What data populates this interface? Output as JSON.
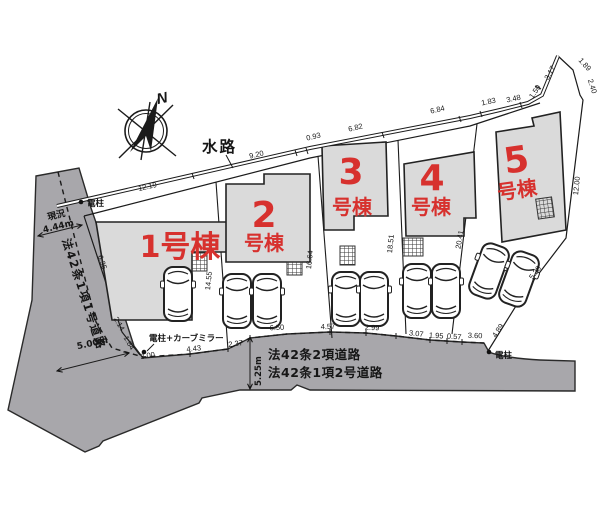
{
  "colors": {
    "road_fill": "#a8a7ab",
    "building_fill": "#dadada",
    "lot_label": "#d7312e",
    "line": "#1b1b1b"
  },
  "compass": {
    "north": "N"
  },
  "waterway": {
    "name": "水路",
    "segments": [
      "12.19",
      "9.20",
      "0.93",
      "6.82",
      "6.84",
      "1.83",
      "3.48",
      "1.59",
      "3.17"
    ]
  },
  "east_boundary": {
    "segments": [
      "1.89",
      "2.40",
      "12.00",
      "5.28",
      "4.89"
    ]
  },
  "lot_boundary_dims": {
    "d1_2": "14.55",
    "d2_3": "16.64",
    "d3_4": "18.51",
    "d4_5": "20.41"
  },
  "west_road": {
    "name": "法42条1項1号道路",
    "existing_label": "現況",
    "existing_width": "4.44m",
    "width": "5.00m",
    "corner_segments": [
      "2.14",
      "1.84"
    ],
    "front_dim": "3.00",
    "lot1_edge_dim": "6.35"
  },
  "south_road": {
    "name_line1": "法42条2項道路",
    "name_line2": "法42条1項2号道路",
    "width": "5.25m",
    "frontage_dims": [
      "4.43",
      "2.37",
      "6.50",
      "4.57",
      "2.99",
      "3.07",
      "1.95",
      "0.57",
      "3.60"
    ]
  },
  "poles": {
    "northwest": "電柱",
    "corner": "電柱+カーブミラー",
    "southeast": "電柱"
  },
  "lots": [
    {
      "label": "1号棟",
      "num": "1",
      "suffix": "号棟"
    },
    {
      "label": "2号棟",
      "num": "2",
      "suffix": "号棟"
    },
    {
      "label": "3号棟",
      "num": "3",
      "suffix": "号棟"
    },
    {
      "label": "4号棟",
      "num": "4",
      "suffix": "号棟"
    },
    {
      "label": "5号棟",
      "num": "5",
      "suffix": "号棟"
    }
  ]
}
